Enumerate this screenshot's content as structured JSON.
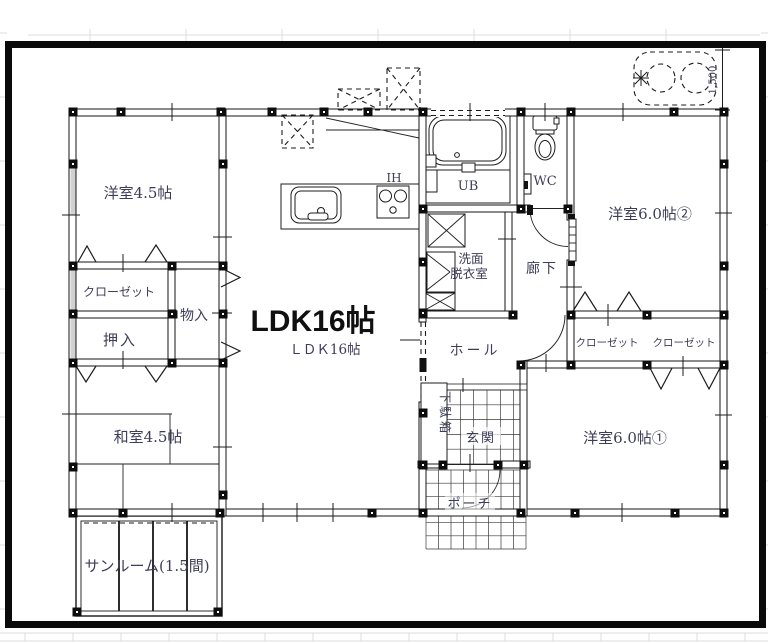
{
  "plan": {
    "labels": {
      "room_west_45": "洋室4.5帖",
      "closet_west": "クローゼット",
      "oshiire": "押入",
      "mono_ire": "物入",
      "washitsu_45": "和室4.5帖",
      "sunroom": "サンルーム(1.5間)",
      "ldk_main": "LDK16帖",
      "ldk_sub": "ＬＤＫ16帖",
      "ih": "IH",
      "ub": "UB",
      "wc": "WC",
      "senmen_line1": "洗面",
      "senmen_line2": "脱衣室",
      "rouka": "廊下",
      "hall": "ホール",
      "getabako": "下駄箱",
      "genkan": "玄関",
      "porch": "ポーチ",
      "room_east_60_2": "洋室6.0帖②",
      "closet_east_1": "クローゼット",
      "closet_east_2": "クローゼット",
      "room_east_60_1": "洋室6.0帖①",
      "dimension": "1,500"
    },
    "colors": {
      "line": "#141414",
      "label": "#3d3d58",
      "bold_label": "#101010",
      "faint_grid": "#d8dce0"
    }
  }
}
